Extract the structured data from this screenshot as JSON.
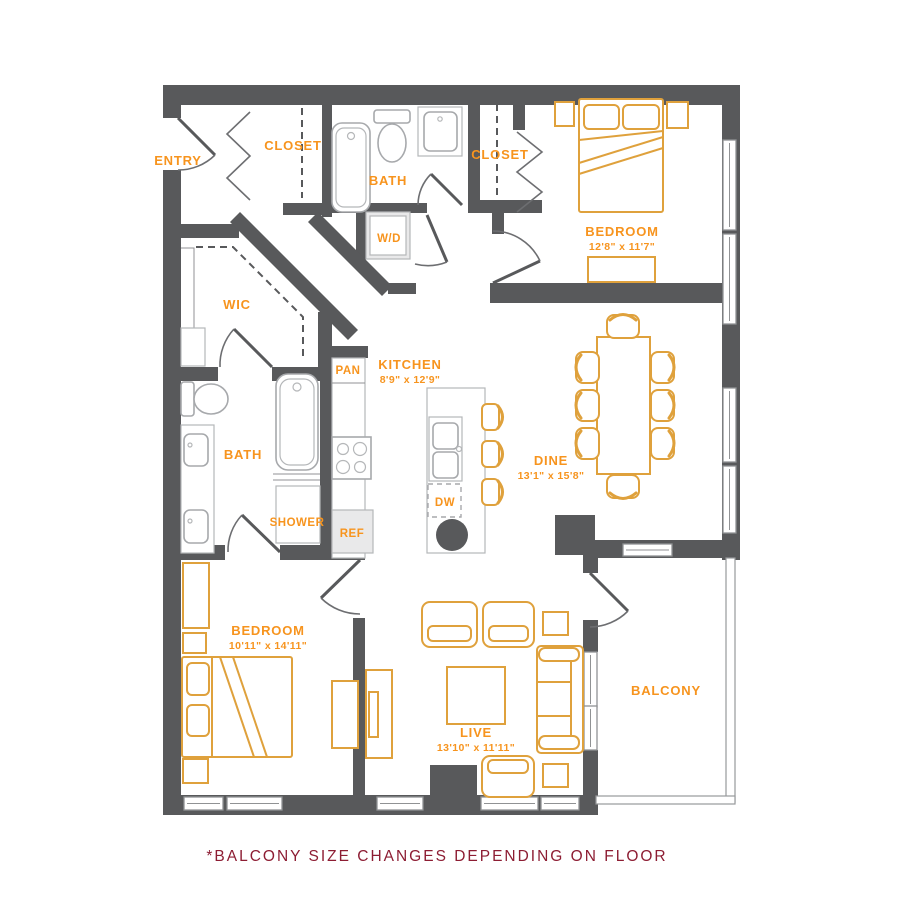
{
  "title": "Two bedroom apartment floor plan",
  "footnote": "*BALCONY SIZE CHANGES DEPENDING ON FLOOR",
  "colors": {
    "wall": "#58595B",
    "furniture_outline": "#DFA13C",
    "label_orange": "#F7941E",
    "fixture_gray": "#A7A9AC",
    "footnote_maroon": "#8D1D33"
  },
  "rooms": {
    "entry": {
      "label": "ENTRY"
    },
    "closet_entry": {
      "label": "CLOSET"
    },
    "bath_upper": {
      "label": "BATH"
    },
    "washer_dryer": {
      "label": "W/D"
    },
    "closet_bedroom1": {
      "label": "CLOSET"
    },
    "bedroom1": {
      "label": "BEDROOM",
      "dims": "12'8\" x 11'7\""
    },
    "wic": {
      "label": "WIC"
    },
    "pantry": {
      "label": "PAN"
    },
    "kitchen": {
      "label": "KITCHEN",
      "dims": "8'9\" x 12'9\""
    },
    "dishwasher": {
      "label": "DW"
    },
    "refrigerator": {
      "label": "REF"
    },
    "dining": {
      "label": "DINE",
      "dims": "13'1\" x 15'8\""
    },
    "bath_main": {
      "label": "BATH"
    },
    "shower": {
      "label": "SHOWER"
    },
    "bedroom2": {
      "label": "BEDROOM",
      "dims": "10'11\" x 14'11\""
    },
    "living": {
      "label": "LIVE",
      "dims": "13'10\" x 11'11\""
    },
    "balcony": {
      "label": "BALCONY"
    }
  }
}
